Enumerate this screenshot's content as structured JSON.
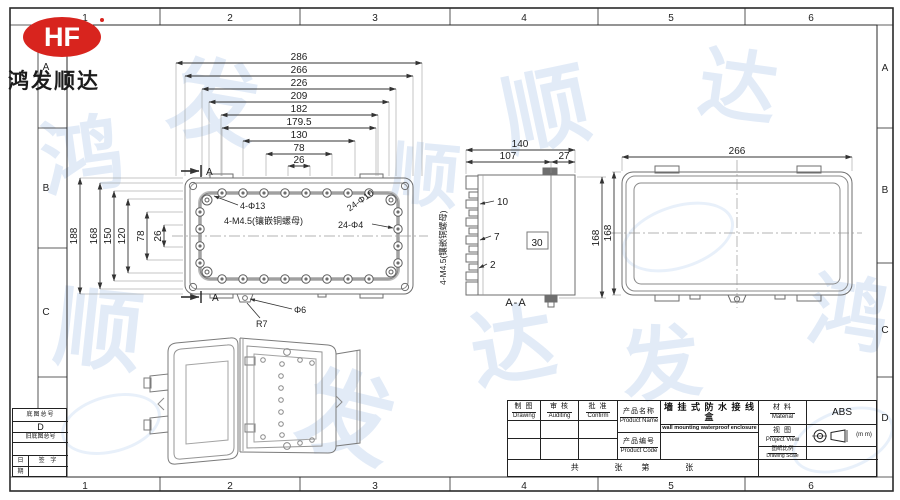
{
  "logo": {
    "brand": "HF",
    "company": "鸿发顺达"
  },
  "grid": {
    "c1": "1",
    "c2": "2",
    "c3": "3",
    "c4": "4",
    "c5": "5",
    "c6": "6",
    "rA": "A",
    "rB": "B",
    "rC": "C",
    "rD": "D"
  },
  "corner_table": {
    "base_no": "底图总号",
    "old_base_no": "旧底图总号",
    "sign": "签 字",
    "day": "日",
    "period": "期"
  },
  "plan": {
    "hd": [
      "286",
      "266",
      "226",
      "209",
      "182",
      "179.5",
      "130",
      "78",
      "26"
    ],
    "vd": [
      "188",
      "168",
      "150",
      "120",
      "78",
      "26"
    ],
    "a_marker": "A",
    "ann_corner": "4-Φ13",
    "ann_insert": "4-M4.5(镶嵌铜螺母)",
    "ann_cbore": "24-Φ10",
    "ann_holes": "24-Φ4",
    "ann_d6": "Φ6",
    "ann_r7": "R7"
  },
  "section": {
    "label": "A-A",
    "d140": "140",
    "d107": "107",
    "d27": "27",
    "d10": "10",
    "d7": "7",
    "d2": "2",
    "d30": "30",
    "d168": "168",
    "note": "4-M4.5(镶嵌铜螺母)"
  },
  "back": {
    "w": "266",
    "h": "168"
  },
  "title_block": {
    "drafter_zh": "制 图",
    "drafter_en": "Drawing",
    "auditor_zh": "审 核",
    "auditor_en": "Auditing",
    "approver_zh": "批 准",
    "approver_en": "Confirm",
    "pname_label_zh": "产品名称",
    "pname_label_en": "Product Name",
    "pname_zh": "墙 挂 式 防 水 接 线 盒",
    "pname_en": "wall mounting waterproof enclosure",
    "pcode_label_zh": "产品编号",
    "pcode_label_en": "Product Code",
    "material_zh": "材 料",
    "material_en": "Material",
    "material_value": "ABS",
    "view_zh": "视 图",
    "view_en": "Project View",
    "unit": "(m m)",
    "scale_zh": "图纸比例",
    "scale_en": "Drawing Scale",
    "sheet_row": "共        张    第        张"
  },
  "watermark": {
    "color": "#cfdef3",
    "chars": [
      "鸿",
      "发",
      "顺",
      "达",
      "顺",
      "发",
      "达",
      "鸿",
      "发",
      "顺"
    ]
  }
}
